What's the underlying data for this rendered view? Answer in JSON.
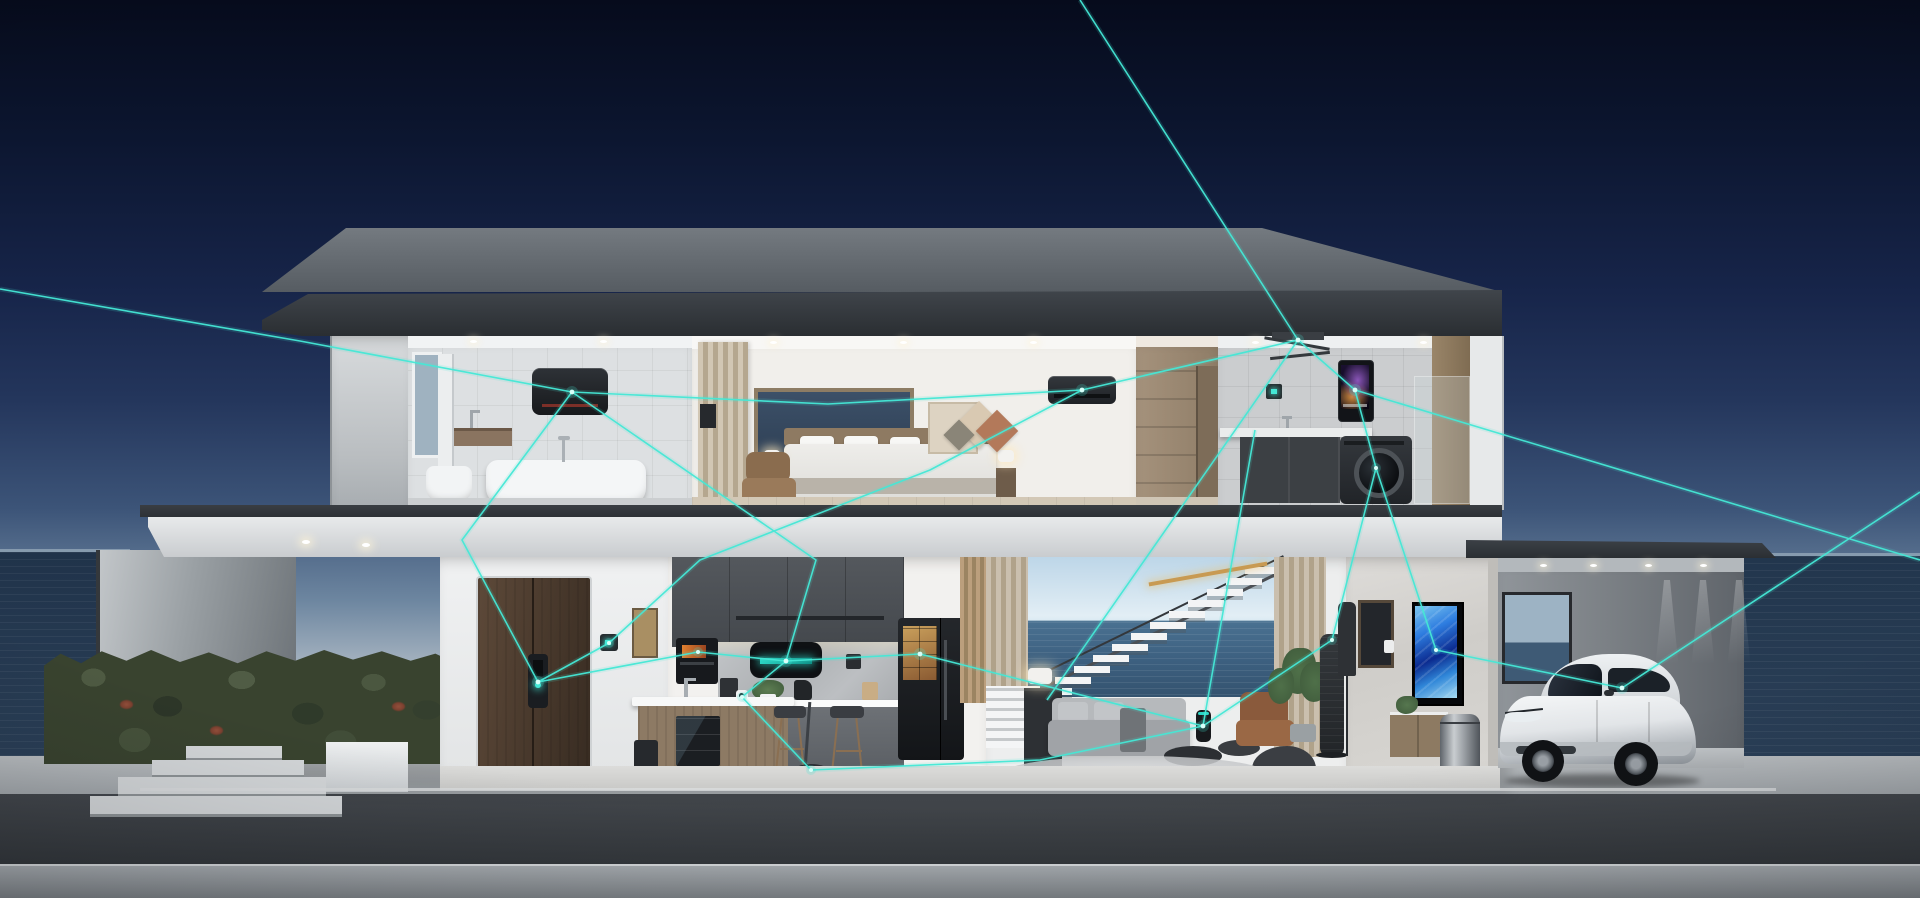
{
  "scene": {
    "description": "Cutaway 3D render of a two-story oceanfront smart home at dusk; smart devices on both floors are linked by glowing teal network lines",
    "time_of_day": "dusk",
    "setting": "oceanfront",
    "text_visible": [],
    "palette": {
      "sky_top": "#060b1c",
      "sky_horizon": "#a9b6c2",
      "ocean": "#2b4058",
      "daylight_view_sky": "#bdd6e8",
      "daylight_view_sea": "#3c5f7f",
      "roof": "#33383d",
      "concrete_deck": "#a2a7ab",
      "deck_face": "#3c4046",
      "wall_white": "#edeeee",
      "cabinet_charcoal": "#494d52",
      "wood": "#8d7a64",
      "door_walnut": "#4a3a2d",
      "hedge_green": "#39432f",
      "network_teal": "#45e8d6"
    },
    "floors": [
      {
        "name": "second-floor",
        "rooms": [
          {
            "name": "bathroom",
            "items": [
              "window",
              "wall-water-heater",
              "vanity-basin",
              "toilet",
              "freestanding-bathtub",
              "tub-faucet",
              "tiled-wall"
            ]
          },
          {
            "name": "bedroom",
            "items": [
              "slatted-curtain",
              "picture-window",
              "wall-tv",
              "double-bed",
              "nightstand-lamps",
              "lounge-chair",
              "geometric-wall-art",
              "air-conditioner",
              "ceiling-downlights"
            ]
          },
          {
            "name": "wardrobe-hall",
            "items": [
              "built-in-wardrobe",
              "doorway"
            ]
          },
          {
            "name": "laundry-room",
            "items": [
              "ceiling-drying-rack",
              "wall-thermostat",
              "smart-water-heater",
              "utility-counter",
              "washing-machine",
              "glass-balustrade"
            ]
          }
        ]
      },
      {
        "name": "first-floor",
        "rooms": [
          {
            "name": "entry",
            "items": [
              "double-front-door",
              "smart-door-lock",
              "wall-thermostat",
              "framed-art",
              "door-mat",
              "floor-speaker"
            ]
          },
          {
            "name": "kitchen",
            "items": [
              "charcoal-upper-cabinets",
              "built-in-oven",
              "range-hood-with-display",
              "marble-backsplash",
              "smart-camera",
              "coffee-maker",
              "kettle",
              "island-with-wine-cooler",
              "bar-stools",
              "smart-refrigerator-with-screen",
              "robot-vacuum"
            ]
          },
          {
            "name": "living-room",
            "items": [
              "slatted-curtains",
              "open-ocean-view",
              "floating-staircase",
              "brass-pendant-light",
              "slatted-storage",
              "sectional-sofa",
              "coffee-tables",
              "smart-speaker",
              "leather-armchair",
              "bean-bag",
              "potted-plant",
              "area-rug",
              "air-purifier-tower",
              "table-lamp"
            ]
          },
          {
            "name": "media-wall",
            "items": [
              "marble-feature-wall",
              "wall-mounted-tv",
              "media-console",
              "framed-picture",
              "light-switch",
              "smart-trash-can",
              "coat-stand"
            ]
          },
          {
            "name": "garage",
            "items": [
              "white-electric-suv",
              "rear-window",
              "recessed-ceiling-lights",
              "wall-wash-lights"
            ]
          }
        ]
      }
    ],
    "exterior": [
      "flat-roof",
      "cantilevered-canopy",
      "privacy-wall",
      "hedge-with-red-flowers",
      "entry-steps",
      "concrete-deck",
      "ocean-horizon-left",
      "ocean-horizon-right"
    ],
    "network": {
      "color": "#45e8d6",
      "style": "glowing straight polylines with bright node dots connecting smart devices",
      "connected_devices": [
        "bathroom-water-heater",
        "smart-door-lock",
        "entry-thermostat",
        "oven",
        "range-hood",
        "refrigerator",
        "kitchen-camera",
        "robot-vacuum",
        "bedroom-air-conditioner",
        "drying-rack",
        "laundry-water-heater",
        "washing-machine",
        "air-purifier-tower",
        "living-room-speaker",
        "wall-tv",
        "electric-car"
      ]
    }
  }
}
